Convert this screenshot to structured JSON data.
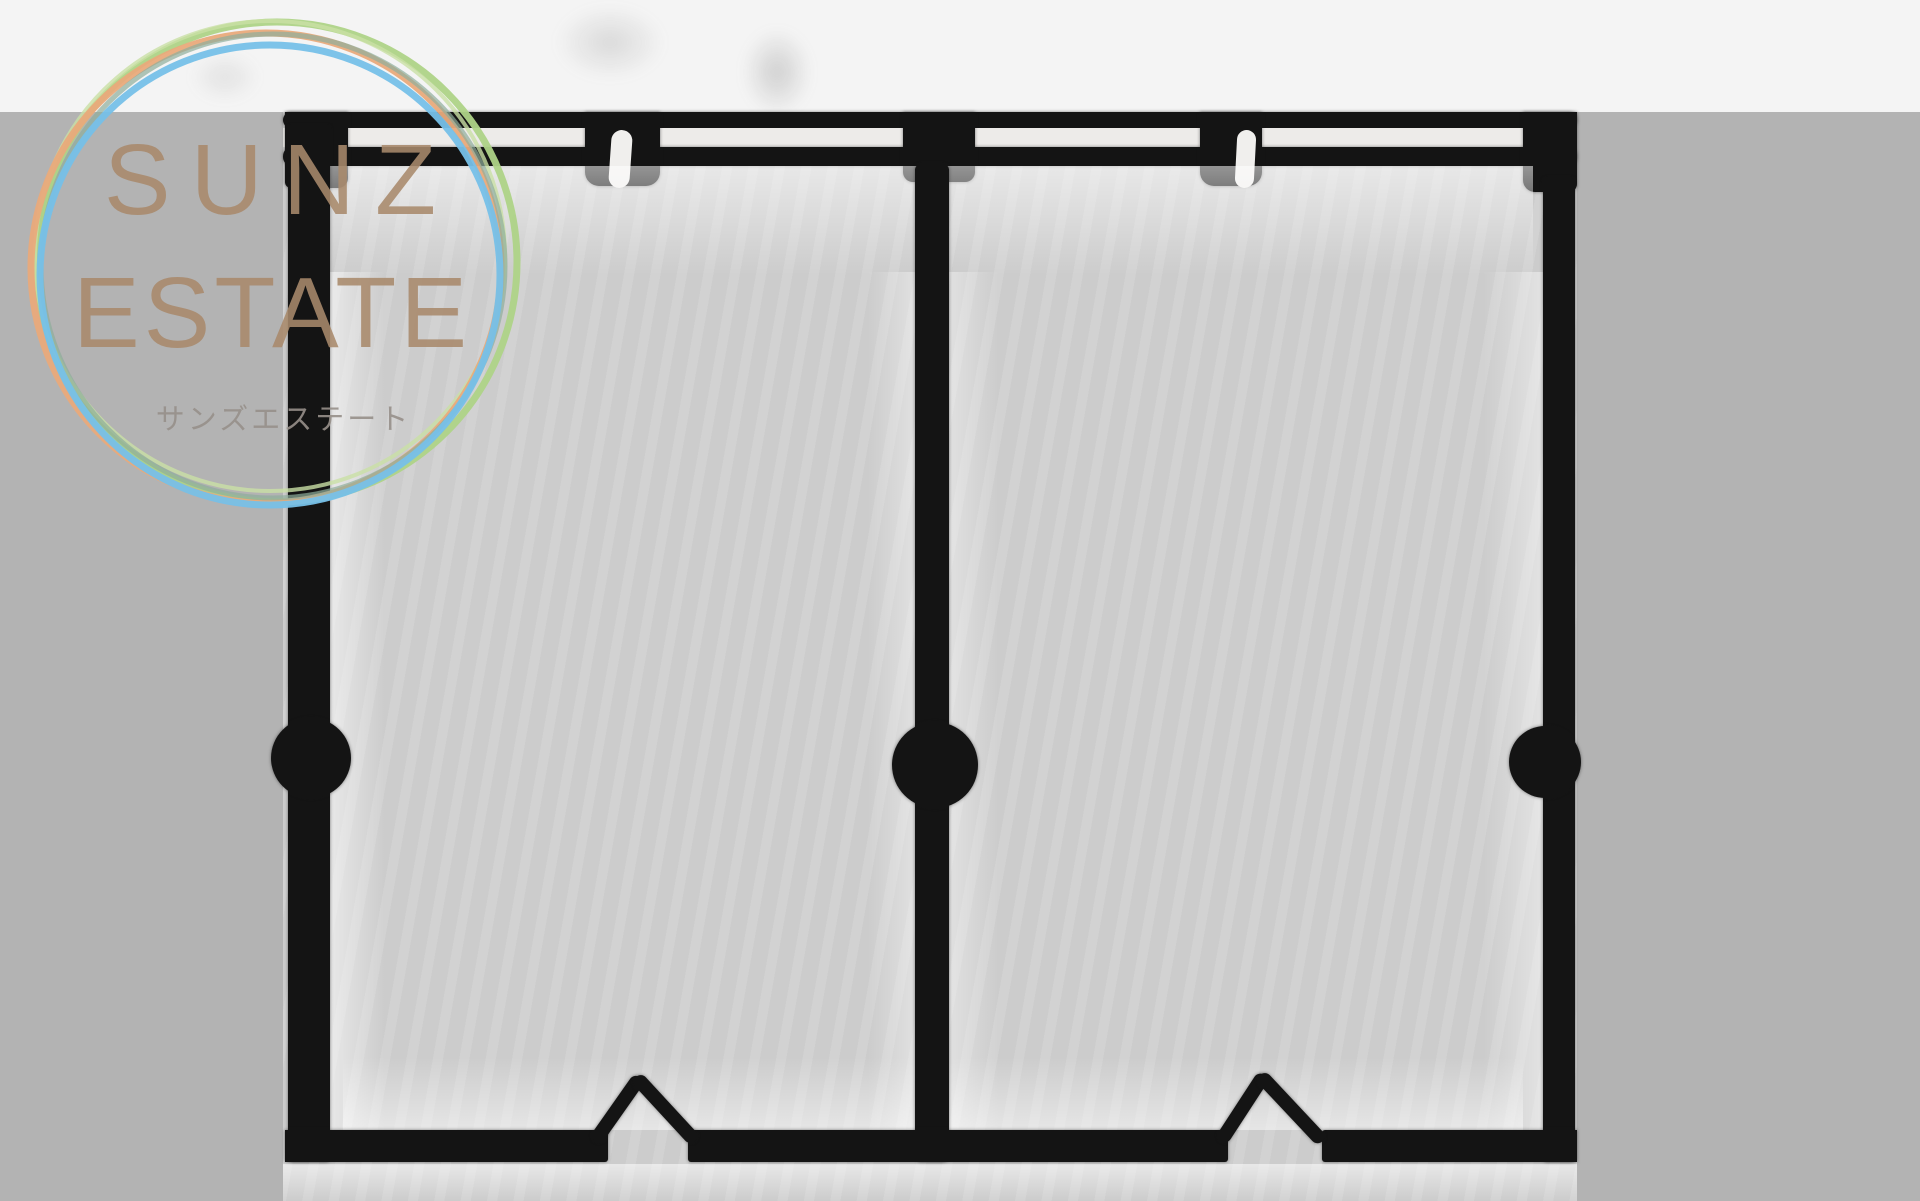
{
  "page": {
    "background_color": "#b3b3b3",
    "top_strip_color": "#f4f4f4"
  },
  "logo": {
    "title_line1": "SUNZ",
    "title_line2": "ESTATE",
    "subtitle": "サンズエステート",
    "title_color": "#a98a6c",
    "subtitle_color": "#97908a",
    "rings": [
      {
        "name": "ring-green",
        "color": "#aed387"
      },
      {
        "name": "ring-green-light",
        "color": "#c9e0a5"
      },
      {
        "name": "ring-orange",
        "color": "#e9aa7b"
      },
      {
        "name": "ring-sage",
        "color": "#8fae9b"
      },
      {
        "name": "ring-blue",
        "color": "#76c0e8"
      }
    ]
  },
  "floor_plan": {
    "kind": "scanned floor plan, two mirrored room units, no text labels",
    "paper_color": "#d0d0d0",
    "wall_color": "#141414",
    "window_gap_color": "#edebe9",
    "units": [
      "room-left",
      "room-right"
    ]
  }
}
